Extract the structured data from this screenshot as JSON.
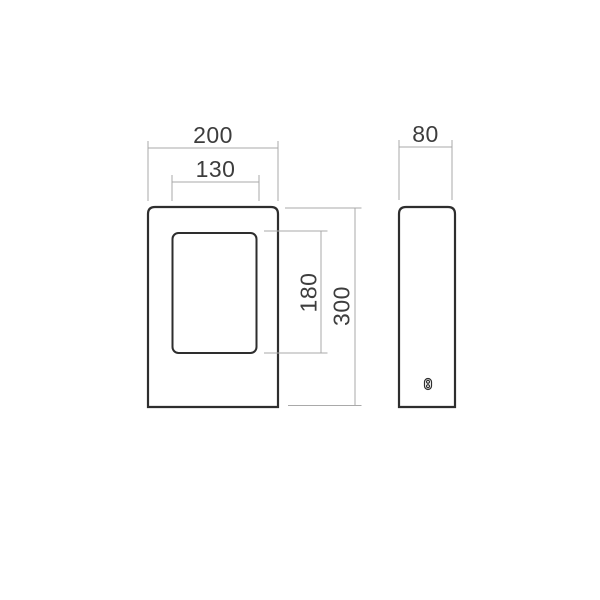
{
  "drawing": {
    "type": "technical-dimension-drawing",
    "dimensions": {
      "front_width": "200",
      "cutout_width": "130",
      "depth": "80",
      "cutout_height": "180",
      "height": "300"
    },
    "colors": {
      "outline": "#2e2e2e",
      "dimension_lines": "#a9a9a9",
      "dimension_text": "#3d3d3d",
      "background": "#ffffff"
    },
    "icons": {
      "screw_detail": "screw-detail-icon"
    }
  }
}
